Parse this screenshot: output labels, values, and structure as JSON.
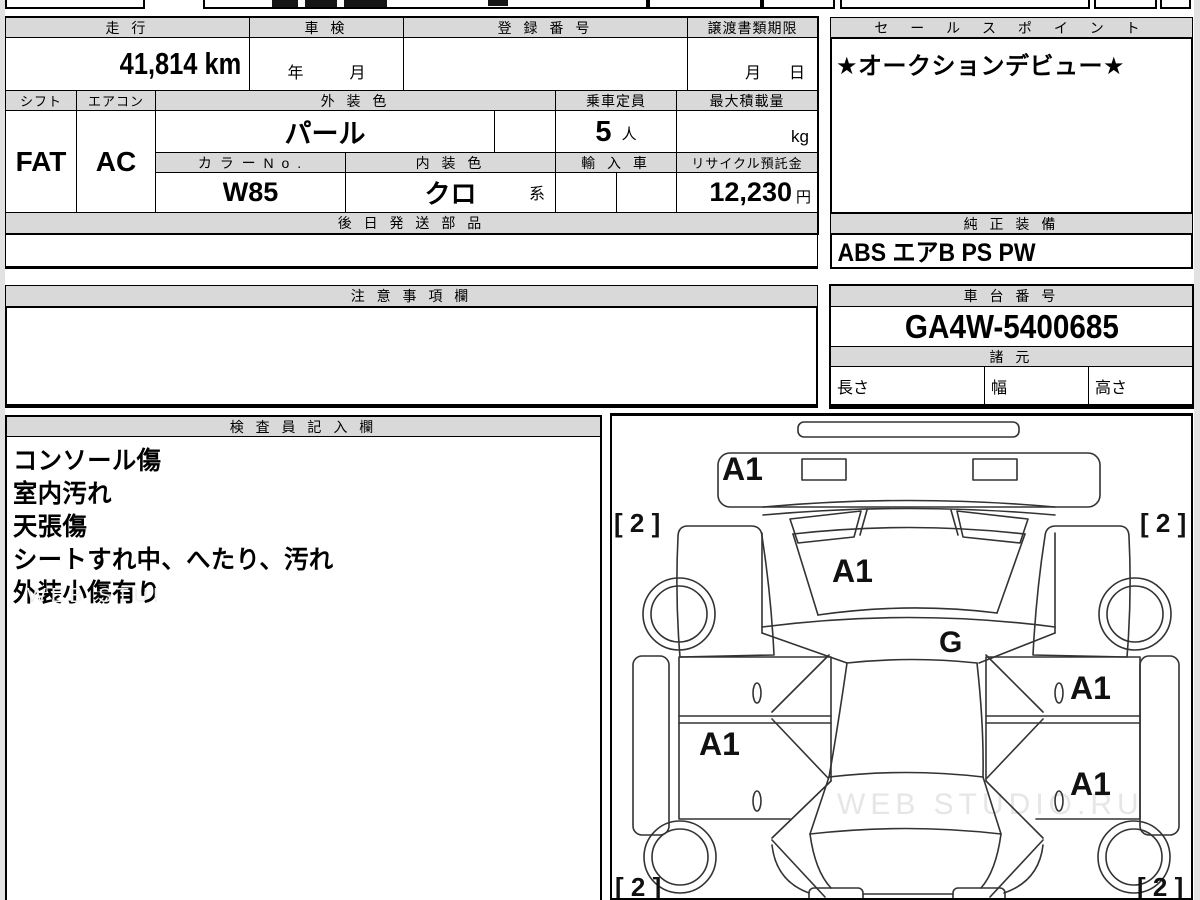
{
  "colors": {
    "header_bg": "#d9d9d9",
    "border": "#000000",
    "watermark_gray": "#e6e6e6"
  },
  "top_table": {
    "odo_label": "走 行",
    "odo_value": "41,814 km",
    "shaken_label": "車 検",
    "shaken_year": "年",
    "shaken_month": "月",
    "reg_label": "登 録 番 号",
    "transfer_label": "譲渡書類期限",
    "transfer_month": "月",
    "transfer_day": "日",
    "shift_label": "シフト",
    "shift_value": "FAT",
    "ac_label": "エアコン",
    "ac_value": "AC",
    "ext_label": "外 装 色",
    "ext_value": "パール",
    "cap_label": "乗車定員",
    "cap_value": "5",
    "cap_unit": "人",
    "load_label": "最大積載量",
    "load_unit": "kg",
    "colorno_label": "カ ラ ー N o .",
    "colorno_value": "W85",
    "int_label": "内 装 色",
    "int_value": "クロ",
    "int_suffix": "系",
    "import_label": "輸 入 車",
    "recycle_label": "リサイクル預託金",
    "recycle_value": "12,230",
    "recycle_unit": "円",
    "parts_label": "後 日 発 送 部 品",
    "parts_value": ""
  },
  "sales_point": {
    "label": "セ ー ル ス ポ イ ン ト",
    "value": "★オークションデビュー★"
  },
  "equipment": {
    "label": "純 正 装 備",
    "value": "ABS エアB PS PW"
  },
  "notes": {
    "label": "注 意 事 項 欄",
    "value": ""
  },
  "chassis": {
    "label": "車 台 番 号",
    "value": "GA4W-5400685",
    "spec_label": "諸 元",
    "length_label": "長さ",
    "width_label": "幅",
    "height_label": "高さ"
  },
  "inspector": {
    "label": "検 査 員 記 入 欄",
    "lines": [
      "コンソール傷",
      "室内汚れ",
      "天張傷",
      "シートすれ中、へたり、汚れ",
      "外装小傷有り"
    ]
  },
  "diagram": {
    "marks": {
      "front_bumper": "A1",
      "hood": "A1",
      "windshield_g": "G",
      "door_front_right": "A1",
      "door_rear_left": "A1",
      "door_rear_right": "A1",
      "tire": "[ 2 ]"
    },
    "watermark": "WEB STUDIO.RU"
  }
}
